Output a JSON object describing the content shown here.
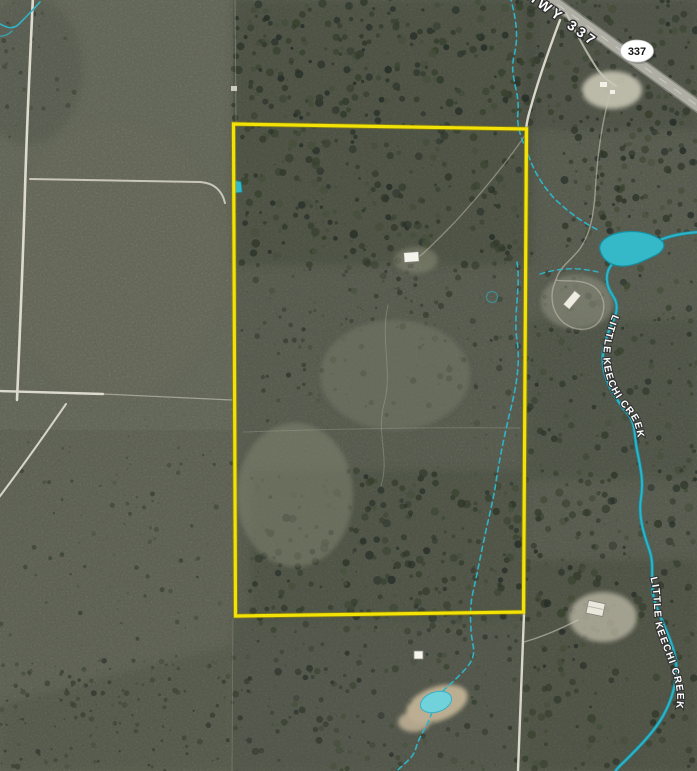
{
  "map": {
    "description": "Aerial satellite view of rural parcel with yellow survey boundary overlay",
    "labels": {
      "highway": "STATE HWY 337",
      "shield": "337",
      "creek_upper": "LITTLE KEECHI CREEK",
      "creek_lower": "LITTLE KEECHI CREEK"
    },
    "colors": {
      "parcel_boundary": "#F2E205",
      "water": "#2FB3C6",
      "pond_fill": "#35B9C9",
      "road": "#D8D6C8",
      "highway_surface": "#AEAEA5",
      "field_light": "#7B7F6E",
      "terrain_dark": "#6D7263",
      "forest": "#39422F",
      "label_text": "#FFFFFF",
      "label_outline": "#2E2E2E",
      "shield_fill": "#FFFFFF",
      "shield_text": "#141414"
    }
  }
}
